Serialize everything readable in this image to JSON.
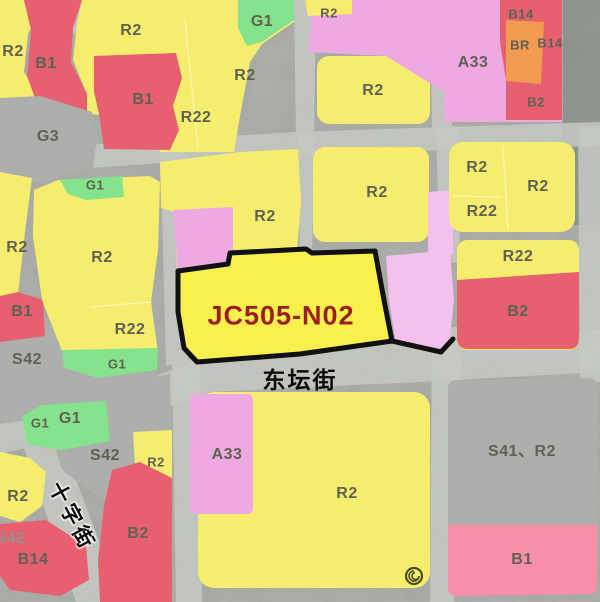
{
  "map": {
    "highlight": {
      "parcel_code": "JC505-N02",
      "text_color": "#9c1e1e",
      "outline_color": "#111111",
      "fill_color": "#f8f04c"
    },
    "streets": {
      "dongtan": "东坛街",
      "shizi": "十字街"
    },
    "watermark_icon": "spiral-logo",
    "colors": {
      "residential_yellow": "#f6ed6e",
      "commercial_red": "#e7606f",
      "public_pink": "#efa9e2",
      "green_space": "#84e38c",
      "utility_gray": "#aeaeac",
      "mixed_orange": "#f29b52",
      "b1_light_pink": "#f78fa9"
    },
    "parcel_labels": [
      {
        "text": "R2"
      },
      {
        "text": "B1"
      },
      {
        "text": "R2"
      },
      {
        "text": "G1"
      },
      {
        "text": "R2"
      },
      {
        "text": "B1"
      },
      {
        "text": "R22"
      },
      {
        "text": "G3"
      },
      {
        "text": "R2"
      },
      {
        "text": "A33"
      },
      {
        "text": "B14"
      },
      {
        "text": "BR"
      },
      {
        "text": "B14"
      },
      {
        "text": "B2"
      },
      {
        "text": "R2"
      },
      {
        "text": "G1"
      },
      {
        "text": "R2"
      },
      {
        "text": "R2"
      },
      {
        "text": "B1"
      },
      {
        "text": "R22"
      },
      {
        "text": "S42"
      },
      {
        "text": "G1"
      },
      {
        "text": "R2"
      },
      {
        "text": "R2"
      },
      {
        "text": "R2"
      },
      {
        "text": "R2"
      },
      {
        "text": "R22"
      },
      {
        "text": "R22"
      },
      {
        "text": "B2"
      },
      {
        "text": "G1"
      },
      {
        "text": "G1"
      },
      {
        "text": "S42"
      },
      {
        "text": "R2"
      },
      {
        "text": "R2"
      },
      {
        "text": "S42"
      },
      {
        "text": "B14"
      },
      {
        "text": "B2"
      },
      {
        "text": "A33"
      },
      {
        "text": "R2"
      },
      {
        "text": "S41、R2"
      },
      {
        "text": "B1"
      }
    ]
  }
}
